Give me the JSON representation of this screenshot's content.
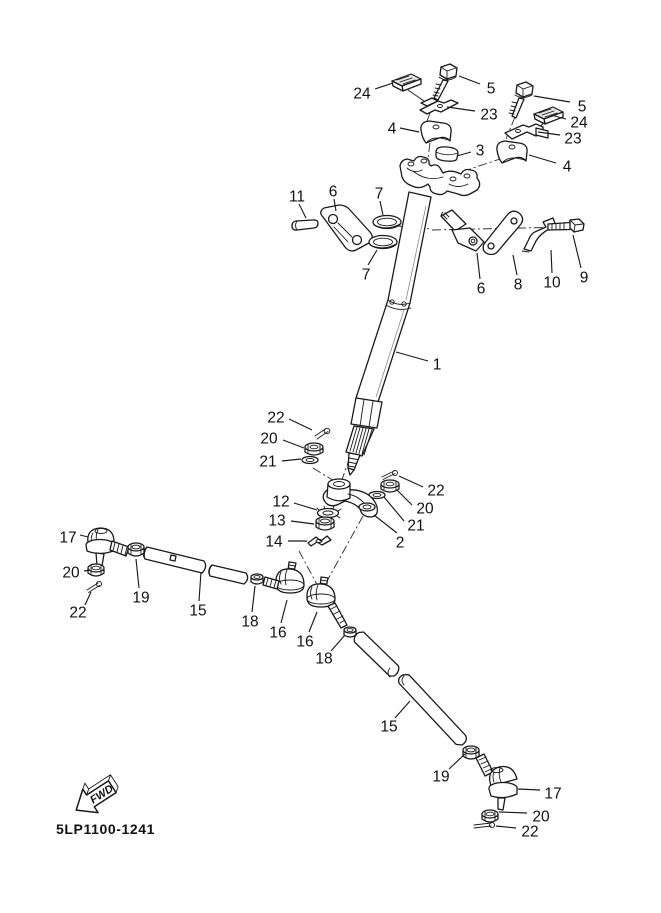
{
  "diagram": {
    "part_code": "5LP1100-1241",
    "fwd_label": "FWD",
    "ink_color": "#1a1a1a",
    "background_color": "#ffffff",
    "callouts": [
      {
        "t": "24",
        "tx": 362,
        "ty": 93,
        "l": [
          375,
          89,
          393,
          83
        ]
      },
      {
        "t": "5",
        "tx": 491,
        "ty": 88,
        "l": [
          480,
          84,
          459,
          76
        ]
      },
      {
        "t": "23",
        "tx": 489,
        "ty": 114,
        "l": [
          475,
          111,
          447,
          107
        ]
      },
      {
        "t": "4",
        "tx": 392,
        "ty": 128,
        "l": [
          400,
          128,
          419,
          132
        ]
      },
      {
        "t": "5",
        "tx": 582,
        "ty": 106,
        "l": [
          570,
          102,
          534,
          96
        ]
      },
      {
        "t": "24",
        "tx": 579,
        "ty": 122,
        "l": [
          566,
          119,
          551,
          115
        ]
      },
      {
        "t": "23",
        "tx": 573,
        "ty": 138,
        "l": [
          560,
          135,
          538,
          132
        ]
      },
      {
        "t": "3",
        "tx": 480,
        "ty": 150,
        "l": [
          471,
          152,
          457,
          156
        ]
      },
      {
        "t": "4",
        "tx": 567,
        "ty": 166,
        "l": [
          556,
          163,
          529,
          155
        ]
      },
      {
        "t": "11",
        "tx": 297,
        "ty": 196,
        "l": [
          299,
          204,
          306,
          218
        ]
      },
      {
        "t": "6",
        "tx": 333,
        "ty": 191,
        "l": [
          334,
          199,
          336,
          211
        ]
      },
      {
        "t": "7",
        "tx": 379,
        "ty": 193,
        "l": [
          380,
          201,
          383,
          215
        ]
      },
      {
        "t": "7",
        "tx": 366,
        "ty": 274,
        "l": [
          368,
          265,
          377,
          250
        ]
      },
      {
        "t": "6",
        "tx": 481,
        "ty": 288,
        "l": [
          480,
          279,
          477,
          253
        ]
      },
      {
        "t": "8",
        "tx": 518,
        "ty": 284,
        "l": [
          517,
          275,
          513,
          255
        ]
      },
      {
        "t": "10",
        "tx": 552,
        "ty": 282,
        "l": [
          552,
          273,
          551,
          250
        ]
      },
      {
        "t": "9",
        "tx": 584,
        "ty": 277,
        "l": [
          581,
          268,
          573,
          235
        ]
      },
      {
        "t": "1",
        "tx": 437,
        "ty": 364,
        "l": [
          428,
          361,
          396,
          352
        ]
      },
      {
        "t": "22",
        "tx": 276,
        "ty": 417,
        "l": [
          289,
          419,
          312,
          430
        ]
      },
      {
        "t": "20",
        "tx": 269,
        "ty": 438,
        "l": [
          283,
          440,
          304,
          448
        ]
      },
      {
        "t": "21",
        "tx": 268,
        "ty": 461,
        "l": [
          282,
          461,
          301,
          459
        ]
      },
      {
        "t": "22",
        "tx": 436,
        "ty": 490,
        "l": [
          423,
          487,
          399,
          476
        ]
      },
      {
        "t": "20",
        "tx": 425,
        "ty": 508,
        "l": [
          412,
          505,
          397,
          490
        ]
      },
      {
        "t": "21",
        "tx": 416,
        "ty": 525,
        "l": [
          404,
          521,
          384,
          497
        ]
      },
      {
        "t": "12",
        "tx": 281,
        "ty": 501,
        "l": [
          294,
          503,
          317,
          510
        ]
      },
      {
        "t": "13",
        "tx": 277,
        "ty": 520,
        "l": [
          291,
          521,
          314,
          524
        ]
      },
      {
        "t": "14",
        "tx": 274,
        "ty": 541,
        "l": [
          288,
          541,
          307,
          541
        ]
      },
      {
        "t": "2",
        "tx": 400,
        "ty": 542,
        "l": [
          397,
          533,
          374,
          515
        ]
      },
      {
        "t": "17",
        "tx": 68,
        "ty": 537,
        "l": [
          80,
          535,
          88,
          537
        ]
      },
      {
        "t": "20",
        "tx": 71,
        "ty": 572,
        "l": [
          84,
          571,
          90,
          570
        ]
      },
      {
        "t": "22",
        "tx": 78,
        "ty": 612,
        "l": [
          85,
          605,
          91,
          592
        ]
      },
      {
        "t": "19",
        "tx": 141,
        "ty": 597,
        "l": [
          139,
          588,
          136,
          559
        ]
      },
      {
        "t": "15",
        "tx": 198,
        "ty": 610,
        "l": [
          199,
          601,
          201,
          572
        ]
      },
      {
        "t": "18",
        "tx": 250,
        "ty": 621,
        "l": [
          252,
          612,
          255,
          586
        ]
      },
      {
        "t": "16",
        "tx": 278,
        "ty": 632,
        "l": [
          281,
          623,
          287,
          600
        ]
      },
      {
        "t": "16",
        "tx": 305,
        "ty": 641,
        "l": [
          309,
          632,
          317,
          612
        ]
      },
      {
        "t": "18",
        "tx": 324,
        "ty": 658,
        "l": [
          331,
          651,
          345,
          635
        ]
      },
      {
        "t": "15",
        "tx": 389,
        "ty": 726,
        "l": [
          395,
          718,
          410,
          701
        ]
      },
      {
        "t": "19",
        "tx": 441,
        "ty": 776,
        "l": [
          449,
          769,
          465,
          754
        ]
      },
      {
        "t": "17",
        "tx": 553,
        "ty": 793,
        "l": [
          540,
          790,
          518,
          789
        ]
      },
      {
        "t": "20",
        "tx": 541,
        "ty": 816,
        "l": [
          527,
          813,
          499,
          812
        ]
      },
      {
        "t": "22",
        "tx": 530,
        "ty": 831,
        "l": [
          516,
          828,
          496,
          826
        ]
      }
    ]
  }
}
